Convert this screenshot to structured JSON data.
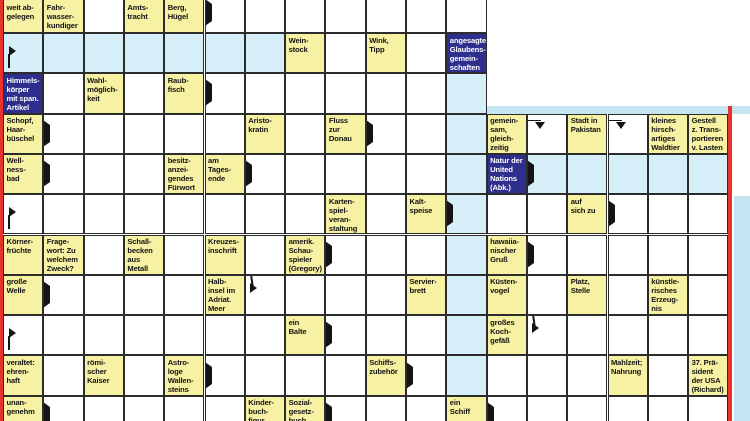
{
  "meta": {
    "app": "newspaper-crossword",
    "description": "German Swedish-style crossword (Schwedenraetsel) grid section, clues in cells, answer paths highlighted"
  },
  "colors": {
    "clue_yellow": "#f6f1a3",
    "highlight_blue": "#d6eef8",
    "dark_blue": "#2e2f8d",
    "strip_cyan": "#c5e5f2",
    "edge_red": "#e8322e",
    "grid_line": "#2c2c2c",
    "text_dark": "#141414",
    "text_light": "#ffffff"
  },
  "grid": {
    "origin_x": 3,
    "origin_y": -7.3,
    "cell": 40.3,
    "regions": [
      {
        "name": "left-block",
        "c_from": 0,
        "c_to": 11,
        "r_from": 0,
        "r_to": 10
      },
      {
        "name": "right-block",
        "c_from": 12,
        "c_to": 17,
        "r_from": 3,
        "r_to": 10
      }
    ],
    "cells": {
      "0-0": {
        "t": "clue",
        "tx": [
          "weit ab-",
          "gelegen"
        ]
      },
      "0-1": {
        "t": "clue",
        "tx": [
          "Fahr-",
          "wasser-",
          "kundiger"
        ]
      },
      "0-3": {
        "t": "clue",
        "tx": [
          "Amts-",
          "tracht"
        ]
      },
      "0-4": {
        "t": "clue",
        "tx": [
          "Berg,",
          "Hügel"
        ]
      },
      "0-5": {
        "ar": [
          "right"
        ]
      },
      "1-0": {
        "t": "hl",
        "ar": [
          "entry"
        ]
      },
      "1-1": {
        "t": "hl",
        "ar": [
          "down"
        ]
      },
      "1-2": {
        "t": "hl"
      },
      "1-3": {
        "t": "hl",
        "ar": [
          "down"
        ]
      },
      "1-4": {
        "t": "hl"
      },
      "1-5": {
        "t": "hl"
      },
      "1-6": {
        "t": "hl"
      },
      "1-7": {
        "t": "clue",
        "tx": [
          "Wein-",
          "stock"
        ]
      },
      "1-9": {
        "t": "clue",
        "tx": [
          "Wink,",
          "Tipp"
        ]
      },
      "1-11": {
        "t": "dark",
        "tx": [
          "angesagte",
          "Glaubens-",
          "gemein-",
          "schaften"
        ]
      },
      "2-0": {
        "t": "dark",
        "tx": [
          "Himmels-",
          "körper",
          "mit span.",
          "Artikel"
        ]
      },
      "2-2": {
        "t": "clue",
        "tx": [
          "Wahl-",
          "möglich-",
          "keit"
        ]
      },
      "2-4": {
        "t": "clue",
        "tx": [
          "Raub-",
          "fisch"
        ]
      },
      "2-5": {
        "ar": [
          "right"
        ]
      },
      "2-7": {
        "ar": [
          "down"
        ]
      },
      "2-9": {
        "ar": [
          "down"
        ]
      },
      "2-11": {
        "t": "hl",
        "ar": [
          "down"
        ]
      },
      "3-0": {
        "t": "clue",
        "tx": [
          "Schopf,",
          "Haar-",
          "büschel"
        ]
      },
      "3-1": {
        "ar": [
          "right"
        ]
      },
      "3-2": {
        "ar": [
          "down"
        ]
      },
      "3-6": {
        "t": "clue",
        "tx": [
          "Aristo-",
          "kratin"
        ]
      },
      "3-8": {
        "t": "clue",
        "tx": [
          "Fluss",
          "zur",
          "Donau"
        ]
      },
      "3-9": {
        "ar": [
          "right"
        ]
      },
      "3-11": {
        "t": "hl"
      },
      "3-12": {
        "t": "clue",
        "tx": [
          "gemein-",
          "sam,",
          "gleich-",
          "zeitig"
        ]
      },
      "3-13": {
        "ar": [
          "bentdown"
        ]
      },
      "3-14": {
        "t": "clue",
        "tx": [
          "Stadt in",
          "Pakistan"
        ]
      },
      "3-15": {
        "ar": [
          "bentdown"
        ]
      },
      "3-16": {
        "t": "clue",
        "tx": [
          "kleines",
          "hirsch-",
          "artiges",
          "Waldtier"
        ]
      },
      "3-17": {
        "t": "clue",
        "tx": [
          "Gestell",
          "z. Trans-",
          "portieren",
          "v. Lasten"
        ]
      },
      "4-0": {
        "t": "clue",
        "tx": [
          "Well-",
          "ness-",
          "bad"
        ]
      },
      "4-1": {
        "ar": [
          "right"
        ]
      },
      "4-4": {
        "t": "clue",
        "tx": [
          "besitz-",
          "anzei-",
          "gendes",
          "Fürwort"
        ]
      },
      "4-5": {
        "t": "clue",
        "tx": [
          "am",
          "Tages-",
          "ende"
        ]
      },
      "4-6": {
        "ar": [
          "down",
          "right"
        ]
      },
      "4-11": {
        "t": "hl"
      },
      "4-12": {
        "t": "dark",
        "tx": [
          "Natur der",
          "United",
          "Nations",
          "(Abk.)"
        ]
      },
      "4-13": {
        "t": "hl",
        "ar": [
          "right"
        ]
      },
      "4-14": {
        "t": "hl"
      },
      "4-15": {
        "t": "hl"
      },
      "4-16": {
        "t": "hl",
        "ar": [
          "down"
        ]
      },
      "4-17": {
        "t": "hl",
        "ar": [
          "down"
        ]
      },
      "5-0": {
        "ar": [
          "entry"
        ]
      },
      "5-4": {
        "ar": [
          "down"
        ]
      },
      "5-8": {
        "t": "clue",
        "tx": [
          "Karten-",
          "spiel-",
          "veran-",
          "staltung"
        ]
      },
      "5-10": {
        "t": "clue",
        "tx": [
          "Kalt-",
          "speise"
        ]
      },
      "5-11": {
        "t": "hl",
        "ar": [
          "right"
        ]
      },
      "5-14": {
        "t": "clue",
        "tx": [
          "auf",
          "sich zu"
        ]
      },
      "5-15": {
        "ar": [
          "right"
        ]
      },
      "6-0": {
        "t": "clue",
        "tx": [
          "Körner-",
          "früchte"
        ]
      },
      "6-1": {
        "t": "clue",
        "tx": [
          "Frage-",
          "wort: Zu",
          "welchem",
          "Zweck?"
        ]
      },
      "6-3": {
        "t": "clue",
        "tx": [
          "Schall-",
          "becken",
          "aus",
          "Metall"
        ]
      },
      "6-5": {
        "t": "clue",
        "tx": [
          "Kreuzes-",
          "inschrift"
        ]
      },
      "6-7": {
        "t": "clue",
        "tx": [
          "amerik.",
          "Schau-",
          "spieler",
          "(Gregory)"
        ]
      },
      "6-8": {
        "ar": [
          "down",
          "right"
        ]
      },
      "6-11": {
        "t": "hl"
      },
      "6-12": {
        "t": "clue",
        "tx": [
          "hawaiia-",
          "nischer",
          "Gruß"
        ]
      },
      "6-13": {
        "ar": [
          "right"
        ]
      },
      "7-0": {
        "t": "clue",
        "tx": [
          "große",
          "Welle"
        ]
      },
      "7-1": {
        "ar": [
          "down",
          "right"
        ]
      },
      "7-3": {
        "ar": [
          "down"
        ]
      },
      "7-5": {
        "t": "clue",
        "tx": [
          "Halb-",
          "insel im",
          "Adriat.",
          "Meer"
        ]
      },
      "7-6": {
        "ar": [
          "bentright"
        ]
      },
      "7-10": {
        "t": "clue",
        "tx": [
          "Servier-",
          "brett"
        ]
      },
      "7-11": {
        "t": "hl"
      },
      "7-12": {
        "t": "clue",
        "tx": [
          "Küsten-",
          "vogel"
        ]
      },
      "7-14": {
        "t": "clue",
        "tx": [
          "Platz,",
          "Stelle"
        ]
      },
      "7-16": {
        "t": "clue",
        "tx": [
          "künstle-",
          "risches",
          "Erzeug-",
          "nis"
        ]
      },
      "8-0": {
        "ar": [
          "entry"
        ]
      },
      "8-5": {
        "ar": [
          "down"
        ]
      },
      "8-7": {
        "t": "clue",
        "tx": [
          "ein",
          "Balte"
        ]
      },
      "8-8": {
        "ar": [
          "right"
        ]
      },
      "8-10": {
        "ar": [
          "down"
        ]
      },
      "8-11": {
        "t": "hl"
      },
      "8-12": {
        "t": "clue",
        "tx": [
          "großes",
          "Koch-",
          "gefäß"
        ]
      },
      "8-13": {
        "ar": [
          "bentright"
        ]
      },
      "8-14": {
        "ar": [
          "down"
        ]
      },
      "8-16": {
        "ar": [
          "down"
        ]
      },
      "9-0": {
        "t": "clue",
        "tx": [
          "veraltet:",
          "ehren-",
          "haft"
        ]
      },
      "9-2": {
        "t": "clue",
        "tx": [
          "römi-",
          "scher",
          "Kaiser"
        ]
      },
      "9-4": {
        "t": "clue",
        "tx": [
          "Astro-",
          "loge",
          "Wallen-",
          "steins"
        ]
      },
      "9-5": {
        "ar": [
          "right"
        ]
      },
      "9-9": {
        "t": "clue",
        "tx": [
          "Schiffs-",
          "zubehör"
        ]
      },
      "9-10": {
        "ar": [
          "right"
        ]
      },
      "9-11": {
        "t": "hl"
      },
      "9-12": {
        "ar": [
          "down"
        ]
      },
      "9-15": {
        "t": "clue",
        "tx": [
          "Mahlzeit;",
          "Nahrung"
        ]
      },
      "9-17": {
        "t": "clue",
        "tx": [
          "37. Prä-",
          "sident",
          "der USA",
          "(Richard)"
        ]
      },
      "10-0": {
        "t": "clue",
        "tx": [
          "unan-",
          "genehm"
        ]
      },
      "10-1": {
        "ar": [
          "right"
        ]
      },
      "10-2": {
        "ar": [
          "down"
        ]
      },
      "10-6": {
        "t": "clue",
        "tx": [
          "Kinder-",
          "buch-",
          "figur"
        ]
      },
      "10-7": {
        "t": "clue",
        "tx": [
          "Sozial-",
          "gesetz-",
          "buch"
        ]
      },
      "10-8": {
        "ar": [
          "right"
        ]
      },
      "10-11": {
        "t": "clue",
        "tx": [
          "ein",
          "Schiff"
        ]
      },
      "10-12": {
        "ar": [
          "right"
        ]
      },
      "10-15": {
        "ar": [
          "down"
        ]
      },
      "10-17": {
        "ar": [
          "down"
        ]
      }
    }
  },
  "decor": {
    "shapes": [
      {
        "name": "left-red-border",
        "x": 0,
        "y": 0,
        "w": 3,
        "h": 421,
        "color": "edge_red"
      },
      {
        "name": "right-section-top-strip",
        "x": 486.6,
        "y": 106.3,
        "w": 263.4,
        "h": 7.6,
        "color": "strip_cyan"
      },
      {
        "name": "right-red-border",
        "x": 728.4,
        "y": 106.3,
        "w": 3.2,
        "h": 314.7,
        "color": "edge_red"
      },
      {
        "name": "far-right-cyan-strip",
        "x": 734,
        "y": 196,
        "w": 16,
        "h": 225,
        "color": "strip_cyan"
      }
    ]
  }
}
